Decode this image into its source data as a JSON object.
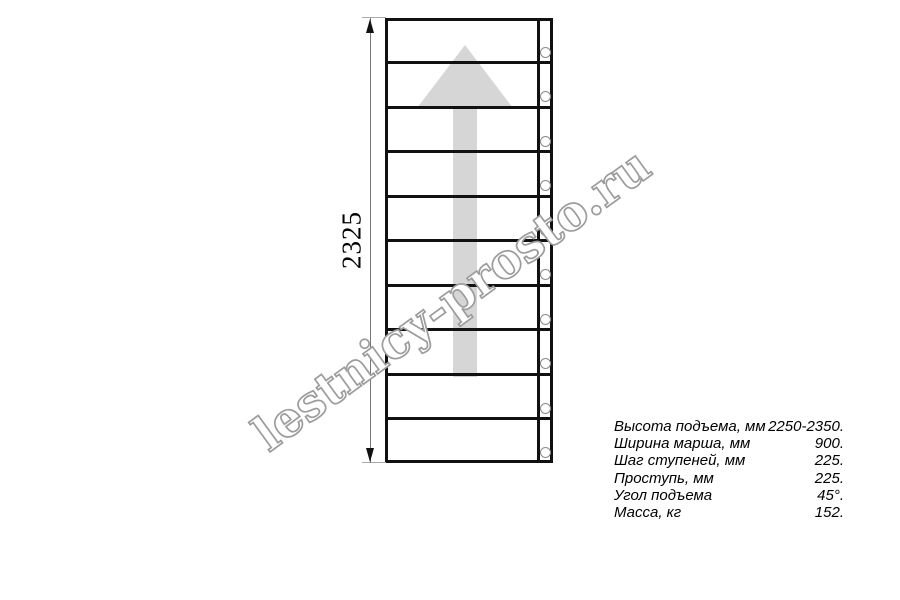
{
  "drawing": {
    "dimension_label": "2325",
    "tread_count": 10,
    "hole_count": 10,
    "arrow_direction": "up"
  },
  "watermark": {
    "text": "lestnicy-prosto.ru"
  },
  "specs": {
    "rows": [
      {
        "label": "Высота подъема, мм",
        "value": "2250-2350."
      },
      {
        "label": "Ширина марша, мм",
        "value": "900."
      },
      {
        "label": "Шаг ступеней, мм",
        "value": "225."
      },
      {
        "label": "Проступь, мм",
        "value": "225."
      },
      {
        "label": "Угол подъема",
        "value": "45°."
      },
      {
        "label": "Масса, кг",
        "value": "152."
      }
    ]
  },
  "colors": {
    "line": "#111111",
    "arrow_fill": "#d6d6d6",
    "watermark_outline": "#9c9c9c",
    "dimension_line": "#777777",
    "hole_stroke": "#8a8a8a",
    "background": "#ffffff"
  }
}
